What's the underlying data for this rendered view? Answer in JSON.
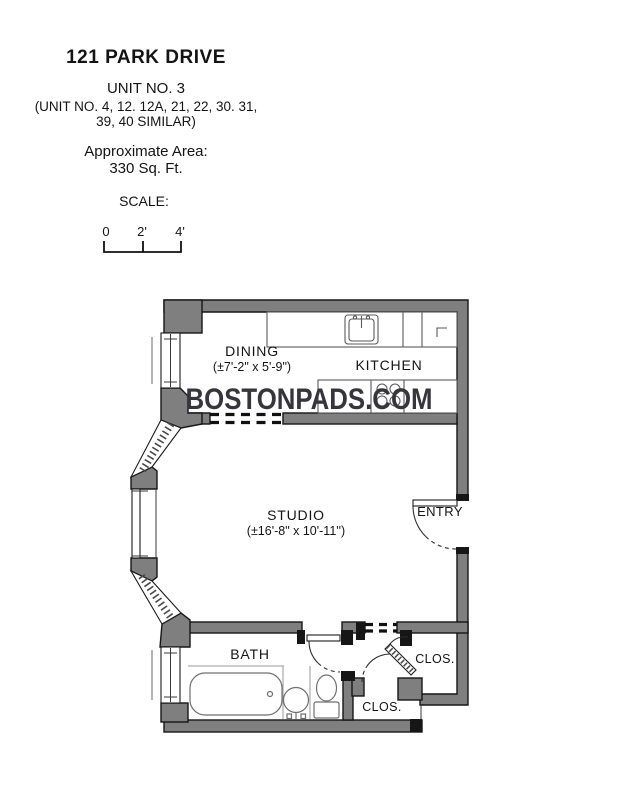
{
  "header": {
    "title": "121 PARK DRIVE",
    "unit_line": "UNIT NO. 3",
    "similar_line1": "(UNIT NO. 4, 12. 12A, 21, 22, 30. 31,",
    "similar_line2": "39, 40 SIMILAR)",
    "area_label": "Approximate Area:",
    "area_value": "330 Sq. Ft.",
    "scale_label": "SCALE:",
    "scale_ticks": [
      "0",
      "2'",
      "4'"
    ]
  },
  "watermark": {
    "text": "BOSTONPADS.COM"
  },
  "rooms": {
    "dining": {
      "name": "DINING",
      "dims": "(±7'-2\" x 5'-9\")"
    },
    "kitchen": {
      "name": "KITCHEN"
    },
    "studio": {
      "name": "STUDIO",
      "dims": "(±16'-8\" x 10'-11'')"
    },
    "entry": {
      "name": "ENTRY"
    },
    "bath": {
      "name": "BATH"
    },
    "closet_upper": {
      "name": "CLOS."
    },
    "closet_lower": {
      "name": "CLOS."
    }
  },
  "colors": {
    "wall_fill": "#7f7f7f",
    "wall_outline": "#161616",
    "fixture_stroke": "#6f6f6f",
    "counter_stroke": "#5a5a5a",
    "text": "#141414",
    "watermark": "#35353c"
  }
}
